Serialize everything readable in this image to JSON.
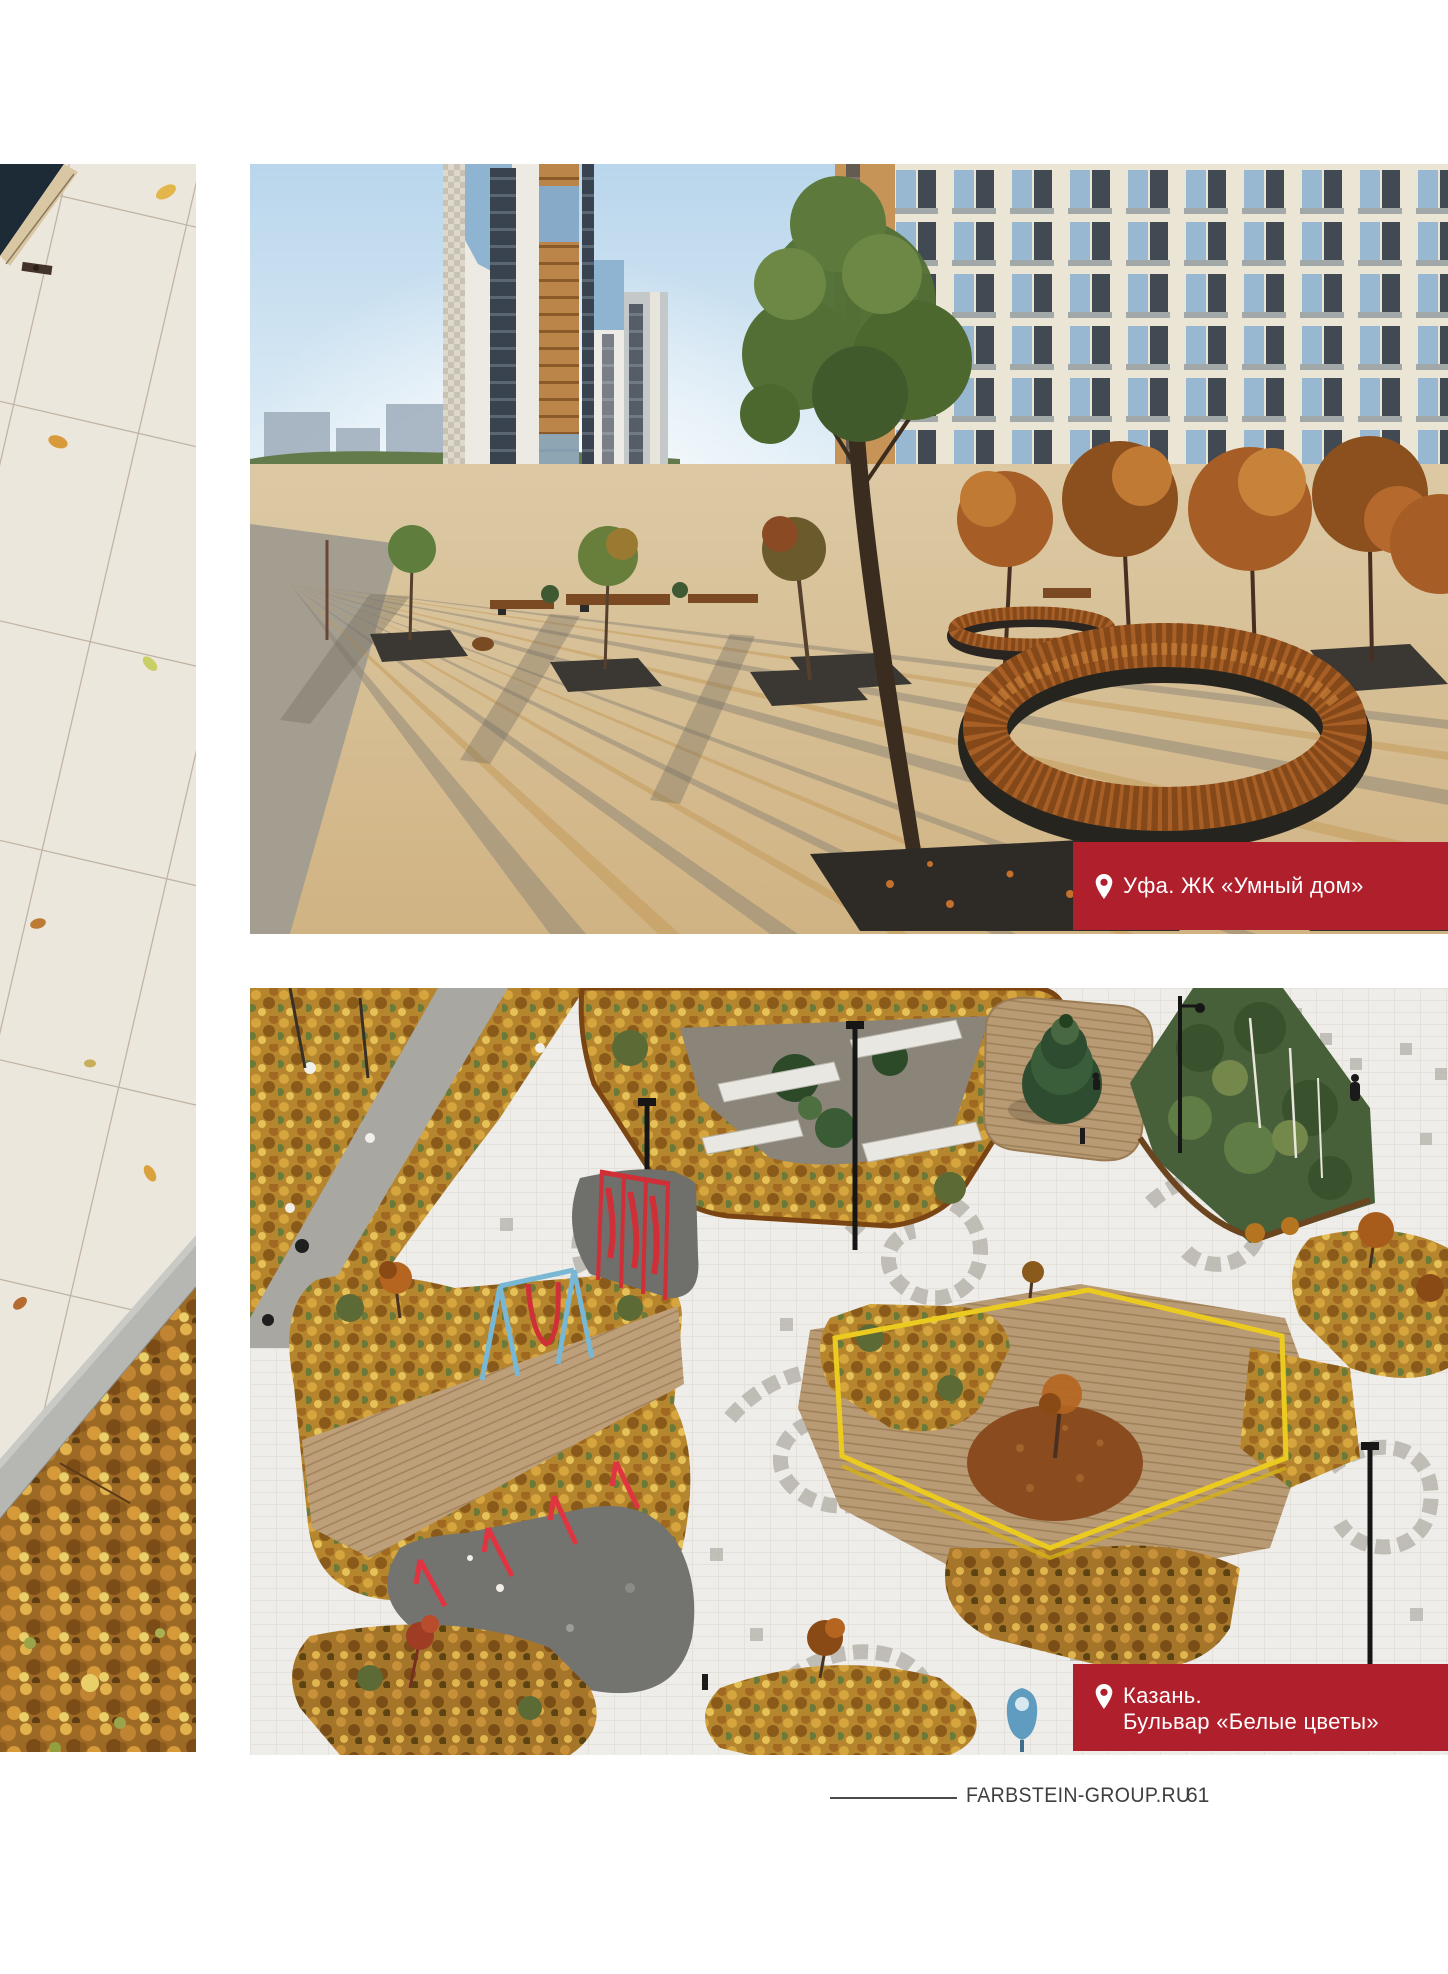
{
  "captions": {
    "ufa": {
      "icon": "location-pin-icon",
      "text": "Уфа. ЖК «Умный дом»",
      "background": "#b01f2c",
      "text_color": "#ffffff"
    },
    "kazan": {
      "icon": "location-pin-icon",
      "line1": "Казань.",
      "line2": "Бульвар «Белые цветы»",
      "background": "#b01f2c",
      "text_color": "#ffffff"
    }
  },
  "footer": {
    "website": "FARBSTEIN-GROUP.RU",
    "page_number": "61",
    "text_color": "#3e3e3e"
  },
  "colors": {
    "accent_red": "#b01f2c",
    "page_background": "#ffffff"
  }
}
